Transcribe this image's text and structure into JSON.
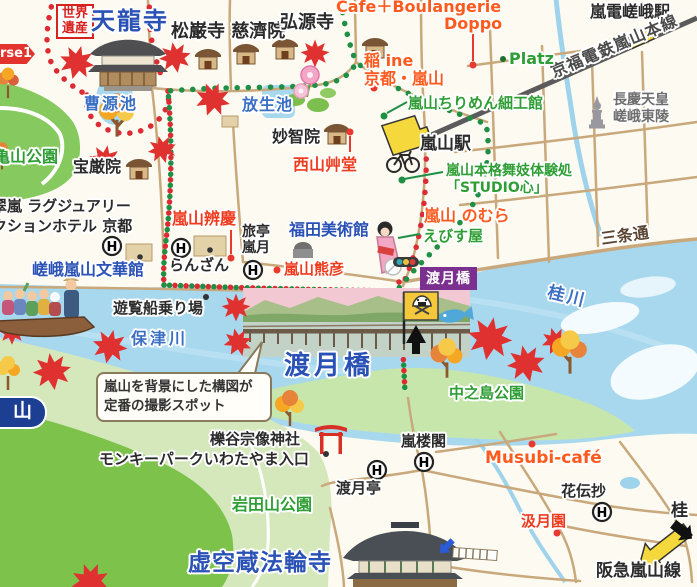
{
  "colors": {
    "route_red": "#DD2B33",
    "route_green": "#1F8F45",
    "water": "#A8D8EE",
    "park_green": "#86C95E",
    "mountain_green": "#7DC24B",
    "heading_blue": "#2A51B5",
    "label_red": "#EF3B1E",
    "label_orange": "#FF5A1E",
    "label_green": "#2F9E35",
    "station_yellow": "#F5D93C",
    "tag_purple": "#7B2F8E",
    "railway_gray": "#5B5B5B"
  },
  "icons": {
    "hotel": "H"
  },
  "labels": {
    "world_heritage": "世界遺産",
    "tenryuji": "天龍寺",
    "shoganji_jisaiin": "松巌寺 慈濟院",
    "kogenji": "弘源寺",
    "cafe_doppo_line1": "Cafe＋Boulangerie",
    "cafe_doppo_line2": "Doppo",
    "randen_saga_station": "嵐電嵯峨駅",
    "keifuku_line": "京福電鉄嵐山本線",
    "course_banner": "rse1",
    "ine_line1": "稲 ine",
    "ine_line2": "京都・嵐山",
    "platz": "Platz",
    "sogen_pond": "曹源池",
    "hojo_pond": "放生池",
    "chirimen_kobo": "嵐山ちりめん細工館",
    "chokei_line1": "長慶天皇",
    "chokei_line2": "嵯峨東陵",
    "arashiyama_station": "嵐山駅",
    "myochiin": "妙智院",
    "seizan_sodo": "西山艸堂",
    "kameyama_park": "亀山公園",
    "hogonin": "宝厳院",
    "maiko_studio_line1": "嵐山本格舞妓体験処",
    "maiko_studio_line2": "「STUDIO心」",
    "benkei": "嵐山辨慶",
    "nomura": "嵐山 のむら",
    "sanjo_dori": "三条通",
    "suiran_line1": "翠嵐 ラグジュアリー",
    "suiran_line2": "クションホテル 京都",
    "ranzan": "らんざん",
    "rangetsu_line1": "旅亭",
    "rangetsu_line2": "嵐月",
    "fukuda_museum": "福田美術館",
    "kumahiko": "嵐山熊彦",
    "ebisuya": "えびす屋",
    "togetsukyo_tag": "渡月橋",
    "bunkakan": "嵯峨嵐山文華館",
    "boat_pier": "遊覧船乗り場",
    "hozu_river": "保津川",
    "yama_capsule": "山",
    "togetsukyo_bridge": "渡月橋",
    "nakanoshima_park": "中之島公園",
    "katsura_river": "桂川",
    "photo_callout_line1": "嵐山を背景にした構図が",
    "photo_callout_line2": "定番の撮影スポット",
    "ichitani_shrine": "櫟谷宗像神社",
    "monkey_park": "モンキーパークいわたやま入口",
    "iwatayama_park": "岩田山公園",
    "togetsutei": "渡月亭",
    "rankaku": "嵐楼閣",
    "musubi_cafe": "Musubi-café",
    "kadensho": "花伝抄",
    "kyugetsuen": "汲月園",
    "katsura_direction": "桂",
    "hankyu_line": "阪急嵐山線",
    "horinji": "虚空蔵法輪寺"
  }
}
